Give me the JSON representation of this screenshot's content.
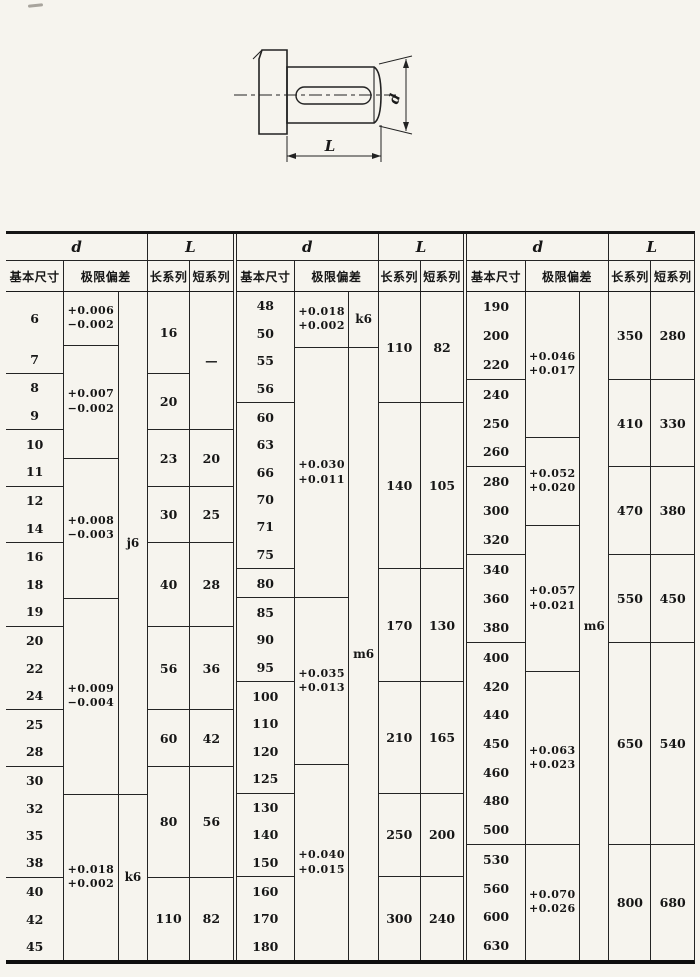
{
  "figure": {
    "dim_d": "d",
    "dim_L": "L"
  },
  "table": {
    "group_headers": {
      "d": "d",
      "L": "L"
    },
    "sub_headers": {
      "basic_size": "基本尺寸",
      "deviation": "极限偏差",
      "long_series": "长系列",
      "short_series": "短系列"
    },
    "blocks": [
      {
        "sizes": [
          "6",
          "7",
          "8",
          "9",
          "10",
          "11",
          "12",
          "14",
          "16",
          "18",
          "19",
          "12x",
          "22",
          "24",
          "25",
          "28",
          "30",
          "32",
          "35",
          "38",
          "40",
          "42",
          "45"
        ],
        "size_group_ends": [
          1,
          3,
          5,
          7,
          10,
          13,
          15,
          19
        ],
        "deviation_cells": [
          {
            "start": 0,
            "end": 0,
            "upper": "+0.006",
            "lower": "−0.002"
          },
          {
            "start": 1,
            "end": 4,
            "upper": "+0.007",
            "lower": "−0.002"
          },
          {
            "start": 5,
            "end": 9,
            "upper": "+0.008",
            "lower": "−0.003"
          },
          {
            "start": 10,
            "end": 16,
            "upper": "+0.009",
            "lower": "−0.004"
          },
          {
            "start": 17,
            "end": 22,
            "upper": "+0.018",
            "lower": "+0.002"
          }
        ],
        "tolerance_cells": [
          {
            "start": 0,
            "end": 16,
            "label": "j6"
          },
          {
            "start": 17,
            "end": 22,
            "label": "k6"
          }
        ],
        "long_cells": [
          {
            "start": 0,
            "end": 1,
            "value": "16"
          },
          {
            "start": 2,
            "end": 3,
            "value": "20"
          },
          {
            "start": 4,
            "end": 5,
            "value": "23"
          },
          {
            "start": 6,
            "end": 7,
            "value": "30"
          },
          {
            "start": 8,
            "end": 10,
            "value": "40"
          },
          {
            "start": 11,
            "end": 13,
            "value": "56"
          },
          {
            "start": 14,
            "end": 15,
            "value": "60"
          },
          {
            "start": 16,
            "end": 19,
            "value": "80"
          },
          {
            "start": 20,
            "end": 22,
            "value": "110"
          }
        ],
        "short_cells": [
          {
            "start": 0,
            "end": 3,
            "value": "—"
          },
          {
            "start": 4,
            "end": 5,
            "value": "20"
          },
          {
            "start": 6,
            "end": 7,
            "value": "25"
          },
          {
            "start": 8,
            "end": 10,
            "value": "28"
          },
          {
            "start": 11,
            "end": 13,
            "value": "36"
          },
          {
            "start": 14,
            "end": 15,
            "value": "42"
          },
          {
            "start": 16,
            "end": 19,
            "value": "56"
          },
          {
            "start": 20,
            "end": 22,
            "value": "82"
          }
        ]
      },
      {
        "sizes": [
          "48",
          "50",
          "55",
          "56",
          "60",
          "63",
          "66",
          "70",
          "71",
          "75",
          "80",
          "85",
          "90",
          "95",
          "100",
          "110",
          "120",
          "125",
          "130",
          "140",
          "150",
          "160",
          "170",
          "180"
        ],
        "size_group_ends": [
          3,
          9,
          10,
          13,
          17,
          20
        ],
        "deviation_cells": [
          {
            "start": 0,
            "end": 1,
            "upper": "+0.018",
            "lower": "+0.002"
          },
          {
            "start": 2,
            "end": 10,
            "upper": "+0.030",
            "lower": "+0.011"
          },
          {
            "start": 11,
            "end": 16,
            "upper": "+0.035",
            "lower": "+0.013"
          },
          {
            "start": 17,
            "end": 23,
            "upper": "+0.040",
            "lower": "+0.015"
          }
        ],
        "tolerance_cells": [
          {
            "start": 0,
            "end": 1,
            "label": "k6"
          },
          {
            "start": 2,
            "end": 23,
            "label": "m6"
          }
        ],
        "long_cells": [
          {
            "start": 0,
            "end": 3,
            "value": "110"
          },
          {
            "start": 4,
            "end": 9,
            "value": "140"
          },
          {
            "start": 10,
            "end": 13,
            "value": "170"
          },
          {
            "start": 14,
            "end": 17,
            "value": "210"
          },
          {
            "start": 18,
            "end": 20,
            "value": "250"
          },
          {
            "start": 21,
            "end": 23,
            "value": "300"
          }
        ],
        "short_cells": [
          {
            "start": 0,
            "end": 3,
            "value": "82"
          },
          {
            "start": 4,
            "end": 9,
            "value": "105"
          },
          {
            "start": 10,
            "end": 13,
            "value": "130"
          },
          {
            "start": 14,
            "end": 17,
            "value": "165"
          },
          {
            "start": 18,
            "end": 20,
            "value": "200"
          },
          {
            "start": 21,
            "end": 23,
            "value": "240"
          }
        ]
      },
      {
        "sizes": [
          "190",
          "200",
          "220",
          "240",
          "250",
          "260",
          "280",
          "300",
          "320",
          "340",
          "360",
          "380",
          "400",
          "420",
          "440",
          "450",
          "460",
          "480",
          "500",
          "530",
          "560",
          "600",
          "630"
        ],
        "size_group_ends": [
          2,
          5,
          8,
          11,
          18
        ],
        "deviation_cells": [
          {
            "start": 0,
            "end": 4,
            "upper": "+0.046",
            "lower": "+0.017"
          },
          {
            "start": 5,
            "end": 7,
            "upper": "+0.052",
            "lower": "+0.020"
          },
          {
            "start": 8,
            "end": 12,
            "upper": "+0.057",
            "lower": "+0.021"
          },
          {
            "start": 13,
            "end": 18,
            "upper": "+0.063",
            "lower": "+0.023"
          },
          {
            "start": 19,
            "end": 22,
            "upper": "+0.070",
            "lower": "+0.026"
          }
        ],
        "tolerance_cells": [
          {
            "start": 0,
            "end": 22,
            "label": "m6"
          }
        ],
        "long_cells": [
          {
            "start": 0,
            "end": 2,
            "value": "350"
          },
          {
            "start": 3,
            "end": 5,
            "value": "410"
          },
          {
            "start": 6,
            "end": 8,
            "value": "470"
          },
          {
            "start": 9,
            "end": 11,
            "value": "550"
          },
          {
            "start": 12,
            "end": 18,
            "value": "650"
          },
          {
            "start": 19,
            "end": 22,
            "value": "800"
          }
        ],
        "short_cells": [
          {
            "start": 0,
            "end": 2,
            "value": "280"
          },
          {
            "start": 3,
            "end": 5,
            "value": "330"
          },
          {
            "start": 6,
            "end": 8,
            "value": "380"
          },
          {
            "start": 9,
            "end": 11,
            "value": "450"
          },
          {
            "start": 12,
            "end": 18,
            "value": "540"
          },
          {
            "start": 19,
            "end": 22,
            "value": "680"
          }
        ]
      }
    ]
  }
}
